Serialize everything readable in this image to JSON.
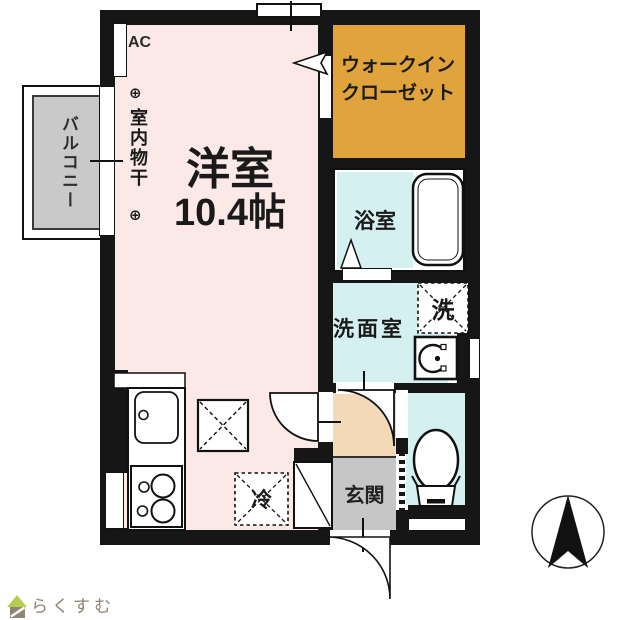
{
  "floor_plan": {
    "room_label": "洋室",
    "room_size": "10.4帖",
    "balcony": "バルコニー",
    "ac": "AC",
    "indoor_drying_pole": "室内物干",
    "pole_symbol": "⊕",
    "walk_in_closet": [
      "ウォークイン",
      "クローゼット"
    ],
    "bathroom": "浴室",
    "washroom": "洗面室",
    "washer": "洗",
    "refrigerator": "冷",
    "entrance": "玄関",
    "colors": {
      "room_pink": "#fbe9e8",
      "closet_orange": "#e1a33c",
      "water_cyan": "#d5f0f0",
      "hallway_peach": "#f4d9b8",
      "entrance_gray": "#c6c6c6",
      "balcony_gray": "#c9c9c9",
      "wall_black": "#161616",
      "logo_green": "#b9cc4e",
      "logo_gray": "#8e8272"
    },
    "compass_direction": "N"
  },
  "footer": {
    "logo_text": "らくすむ"
  }
}
